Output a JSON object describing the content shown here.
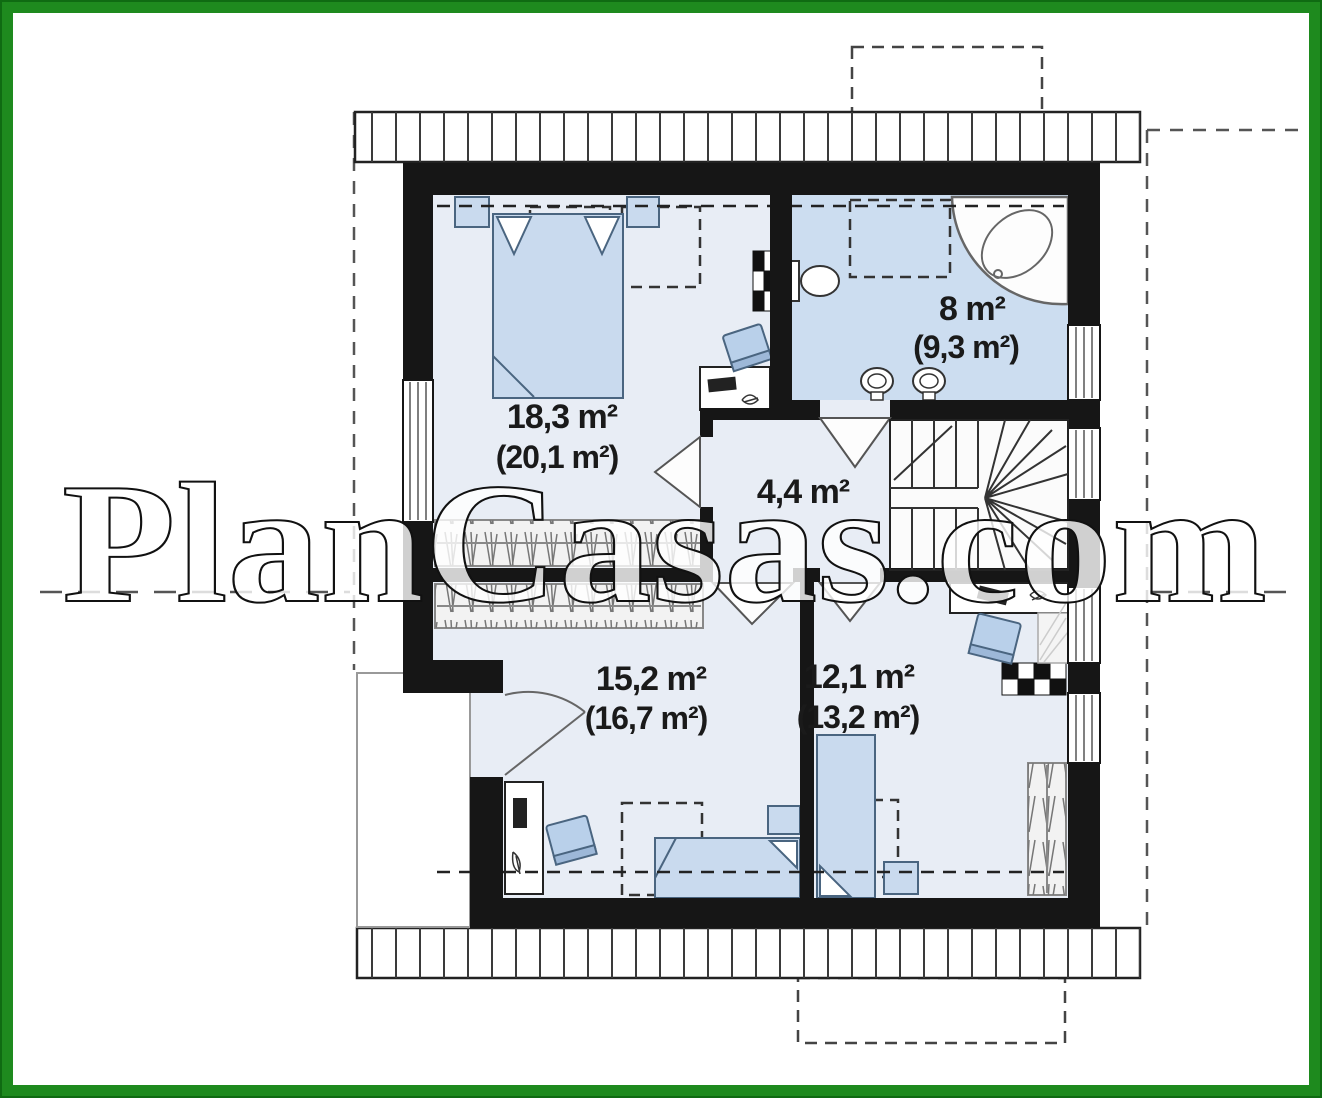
{
  "page": {
    "watermark": "PlanCasas.com"
  },
  "plan": {
    "floor_name": "attic-floor-plan",
    "rooms": [
      {
        "name": "bedroom-top-left",
        "area_net": "18,3 m²",
        "area_gross": "(20,1 m²)"
      },
      {
        "name": "bathroom",
        "area_net": "8 m²",
        "area_gross": "(9,3 m²)"
      },
      {
        "name": "hall",
        "area_net": "4,4 m²",
        "area_gross": ""
      },
      {
        "name": "bedroom-bottom-left",
        "area_net": "15,2 m²",
        "area_gross": "(16,7 m²)"
      },
      {
        "name": "bedroom-bottom-right",
        "area_net": "12,1 m²",
        "area_gross": "(13,2 m²)"
      }
    ],
    "fixtures": [
      "double-bed",
      "nightstand",
      "wardrobe",
      "desk",
      "chair",
      "corner-bathtub",
      "toilet",
      "sink",
      "winder-staircase",
      "balcony",
      "roof-window",
      "chimney-flue"
    ]
  },
  "colors": {
    "frame_green": "#1e8a1e",
    "wall_black": "#161616",
    "floor": "#e8edf5",
    "bathroom_floor": "#ccddf0",
    "furniture_blue": "#c9daee",
    "furniture_stroke": "#4a6580",
    "watermark_fill": "#ffffff",
    "watermark_outline": "#111111"
  }
}
